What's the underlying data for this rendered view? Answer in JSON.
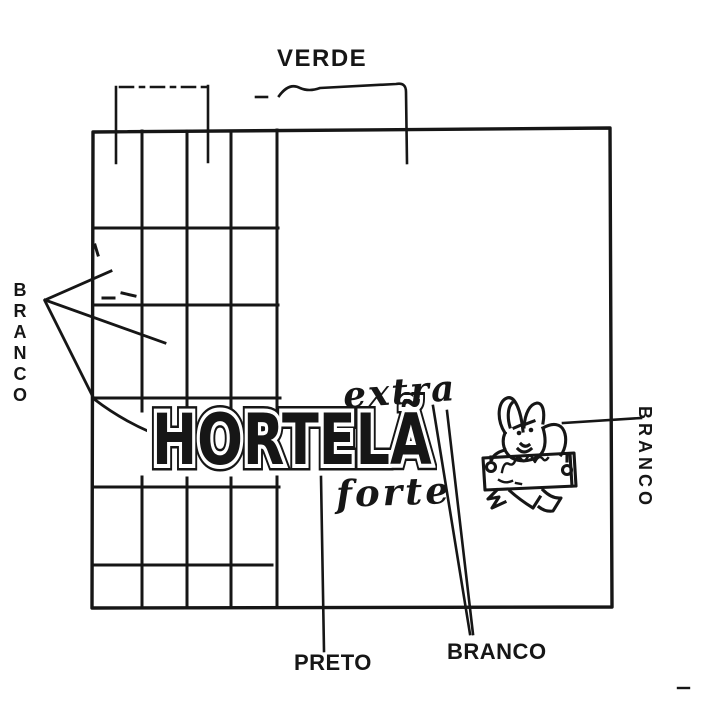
{
  "palette": {
    "ink": "#161616",
    "paper": "#ffffff"
  },
  "callouts": {
    "verde": "VERDE",
    "branco_left": "BRANCO",
    "branco_right": "BRANCO",
    "branco_bottom": "BRANCO",
    "preto": "PRETO"
  },
  "package_art": {
    "brand": "HORTELÃ",
    "script_top": "extra",
    "script_bottom": "forte"
  },
  "icons": {
    "mascot": "rabbit-holding-sign-icon"
  }
}
